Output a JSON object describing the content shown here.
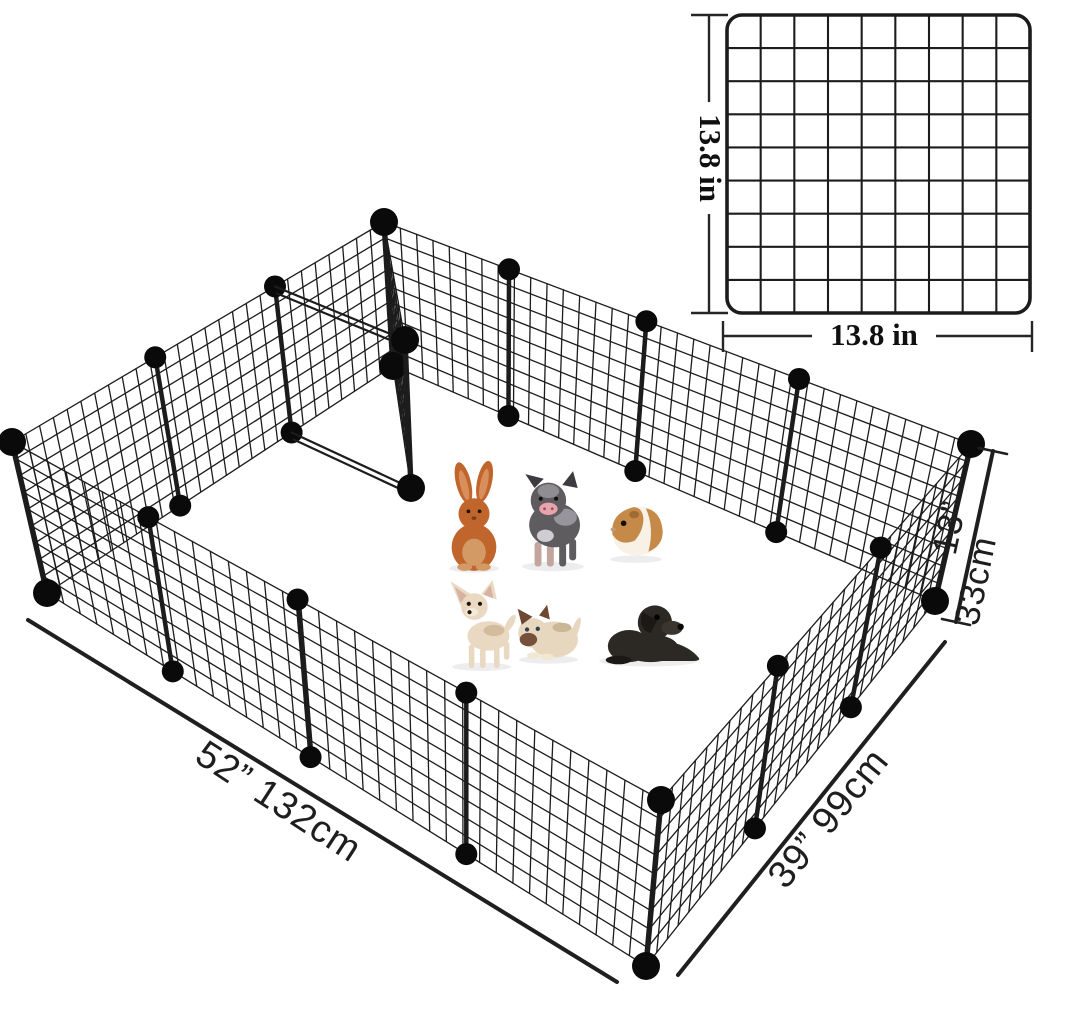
{
  "pen": {
    "length_label": "52” 132cm",
    "width_label": "39” 99cm",
    "height_label_in": "13”",
    "height_label_cm": "33cm",
    "panels_long_side": 4,
    "panels_short_side": 3
  },
  "panel_detail": {
    "width_label": "13.8 in",
    "height_label": "13.8 in",
    "grid_rows": 9,
    "grid_cols": 9
  },
  "animals": [
    {
      "name": "rabbit",
      "color": "#c0662c"
    },
    {
      "name": "piglet",
      "color": "#5f5c60"
    },
    {
      "name": "guinea-pig",
      "color": "#c68a48"
    },
    {
      "name": "chihuahua",
      "color": "#ead9c2"
    },
    {
      "name": "kitten",
      "color": "#e7d7bf"
    },
    {
      "name": "puppy",
      "color": "#2c2824"
    }
  ],
  "colors": {
    "wire": "#1c1c1c",
    "ball": "#0a0a0a",
    "text": "#1e1e1e",
    "background": "#ffffff"
  }
}
